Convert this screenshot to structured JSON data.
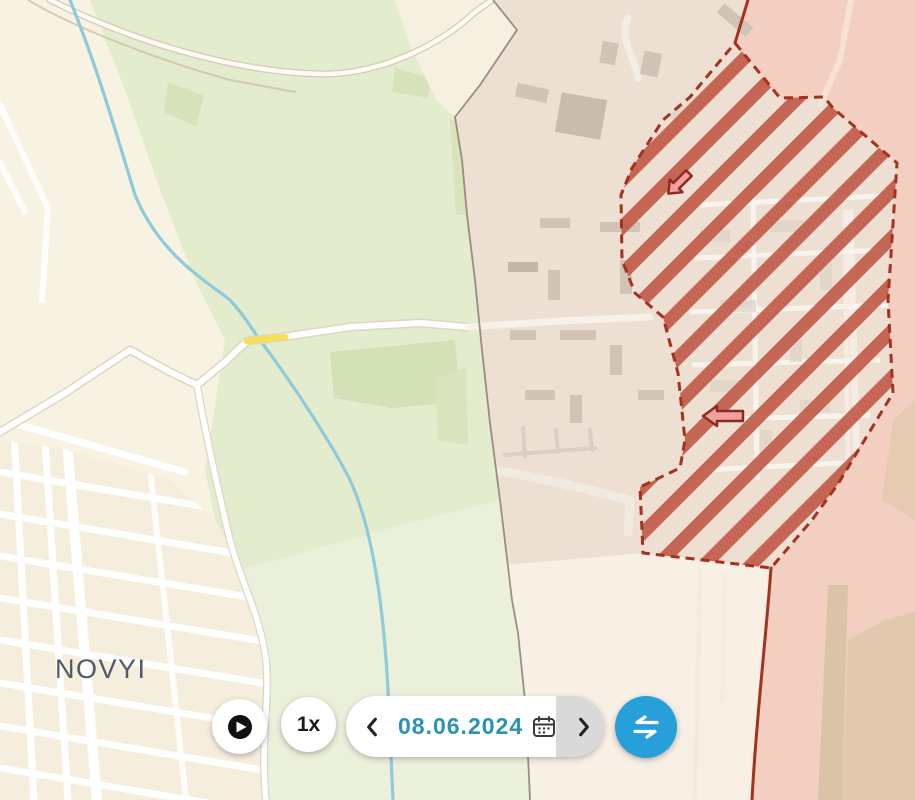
{
  "map": {
    "place_label": "NOVYI",
    "arrows": [
      {
        "direction": "southwest"
      },
      {
        "direction": "west"
      }
    ],
    "colors": {
      "occupied_fill": "#f3cfc1",
      "contested_hatch_stripe": "#c25c4a",
      "frontline_red": "#a5311f",
      "water_blue": "#8fcadb",
      "park_green": "#e3ecce",
      "road_yellow": "#f6df59"
    }
  },
  "controls": {
    "play_icon": "play-icon",
    "speed_label": "1x",
    "prev_icon": "chevron-left-icon",
    "date_value": "08.06.2024",
    "calendar_icon": "calendar-icon",
    "next_icon": "chevron-right-icon",
    "swap_icon": "swap-arrows-icon",
    "accent_blue": "#27a0da",
    "date_text_color": "#2a93b5"
  }
}
